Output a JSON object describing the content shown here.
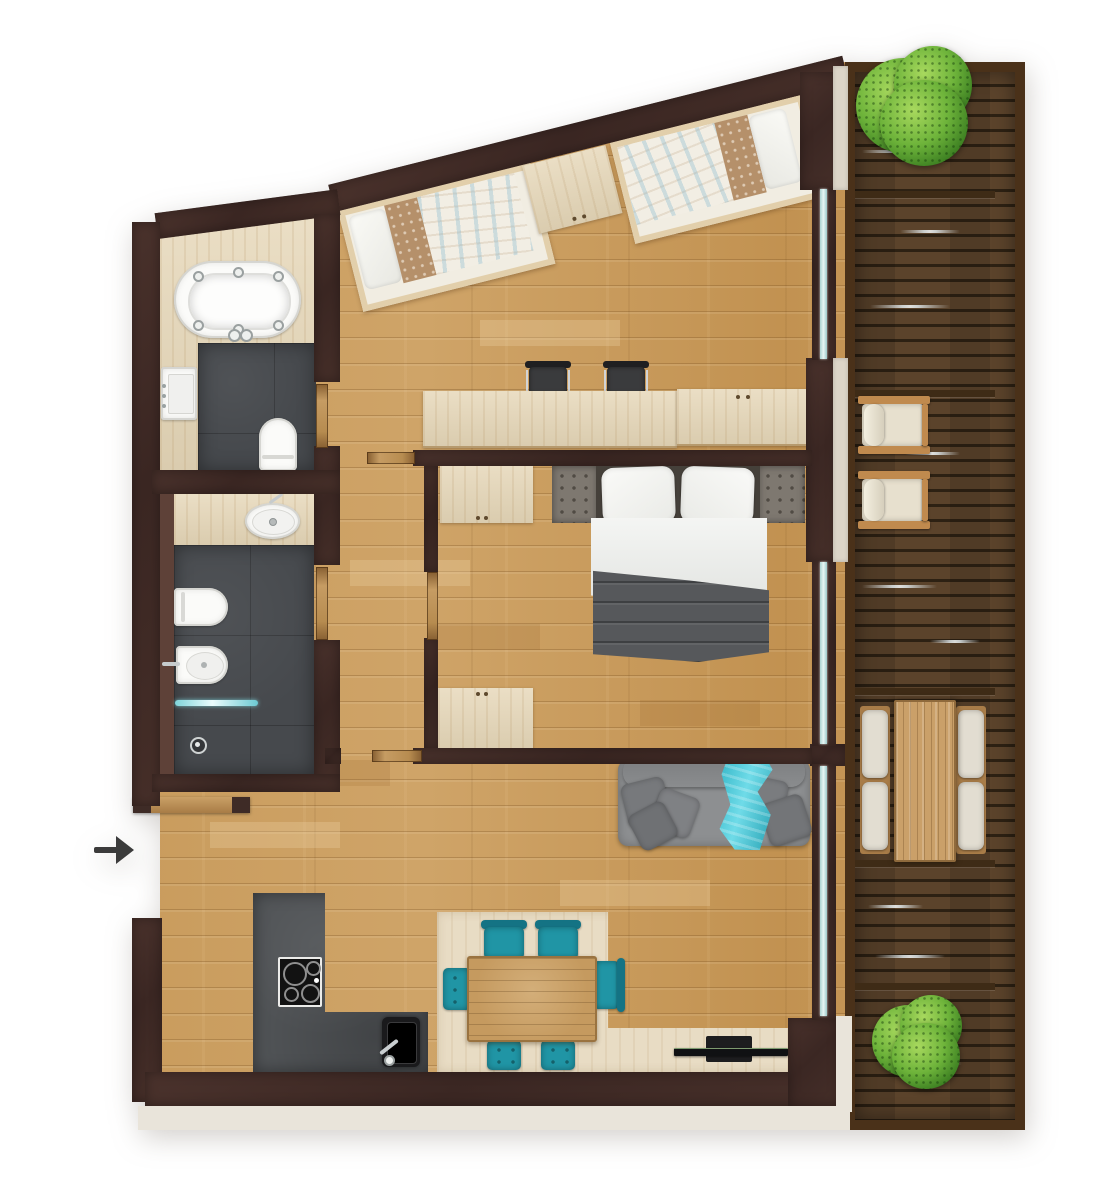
{
  "title": "Apartment floor plan top view with balcony",
  "palette": {
    "background": "#ffffff",
    "wall": "#432c27",
    "floor_wood": "#c89b60",
    "pale_wood": "#e6d7b8",
    "bathroom_tile": "#46494d",
    "deck_wood": "#513a24",
    "deck_frame": "#4a3119",
    "window_glass": "#cfe8e6",
    "window_sill": "#dcd5c8",
    "exterior_trim": "#e9e4da",
    "dining_teal": "#2095a5",
    "throw_teal": "#3ec3d4",
    "sofa_gray": "#8d8f91",
    "blanket_gray": "#56585b",
    "outdoor_cushion": "#e2ddd1",
    "plant_green": "#5aa32e",
    "arrow": "#3b3b3b",
    "fixture_white": "#fbfbf9"
  },
  "entrance": {
    "marker": "arrow",
    "direction": "right"
  },
  "rooms": {
    "bathroom_top": {
      "fixtures": [
        "whirlpool-bathtub",
        "vanity-sink",
        "toilet"
      ]
    },
    "shower_room": {
      "fixtures": [
        "counter-basin",
        "toilet",
        "bidet",
        "glass-shower-screen",
        "floor-drain"
      ]
    },
    "kids_bedroom": {
      "furniture": [
        "single-bed",
        "single-bed",
        "nightstand",
        "desk",
        "desk-chair",
        "desk-chair"
      ]
    },
    "master_bedroom": {
      "furniture": [
        "double-bed",
        "headboard-panel",
        "headboard-panel",
        "wardrobe",
        "dresser"
      ]
    },
    "hallway": {
      "furniture": [
        "entry-console"
      ]
    },
    "living_kitchen": {
      "furniture": [
        "sofa",
        "throw-blanket",
        "tv",
        "media-rug",
        "dining-table",
        "dining-chair",
        "dining-chair",
        "dining-chair",
        "dining-stool",
        "dining-stool",
        "dining-stool",
        "kitchen-counter",
        "cooktop",
        "kitchen-sink"
      ]
    },
    "balcony": {
      "furniture": [
        "plant",
        "armchair",
        "armchair",
        "outdoor-table",
        "bench-cushion",
        "bench-cushion",
        "bench-cushion",
        "bench-cushion",
        "plant"
      ]
    }
  }
}
